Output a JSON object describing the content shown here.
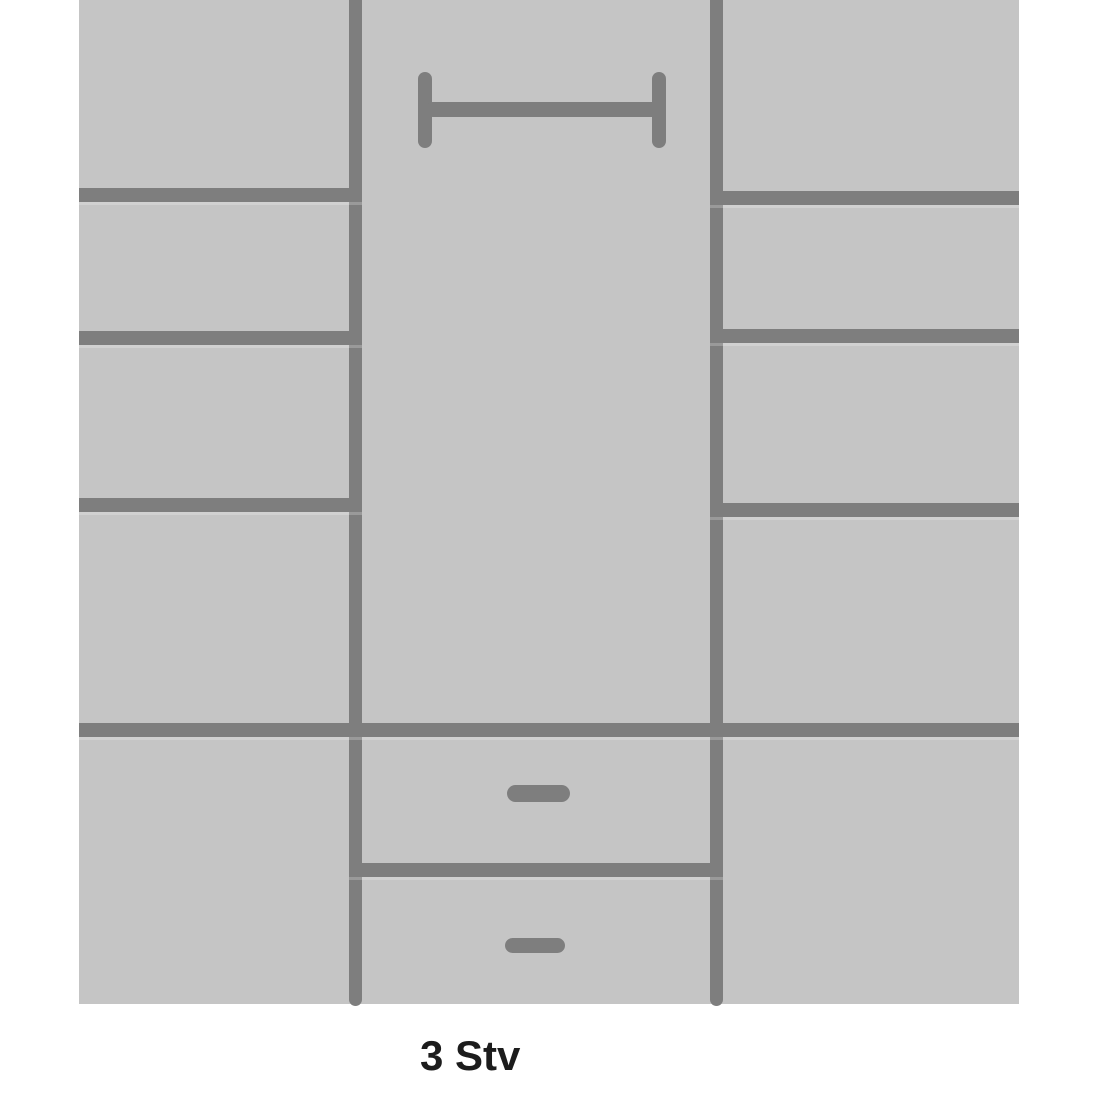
{
  "diagram": {
    "label": "3 Stv",
    "kind": "wardrobe-front-view-schematic",
    "colors": {
      "panel": "#c5c5c5",
      "line": "#7e7e7e",
      "label_text": "#1c1c1c",
      "page_bg": "#ffffff"
    },
    "sections": {
      "left_column": {
        "name": "shelf column",
        "shelf_lines": 3,
        "compartments": 5
      },
      "middle_column": {
        "name": "hanging section",
        "has_rail": true,
        "drawers": 2
      },
      "right_column": {
        "name": "shelf column",
        "shelf_lines": 3,
        "compartments": 5
      }
    }
  }
}
